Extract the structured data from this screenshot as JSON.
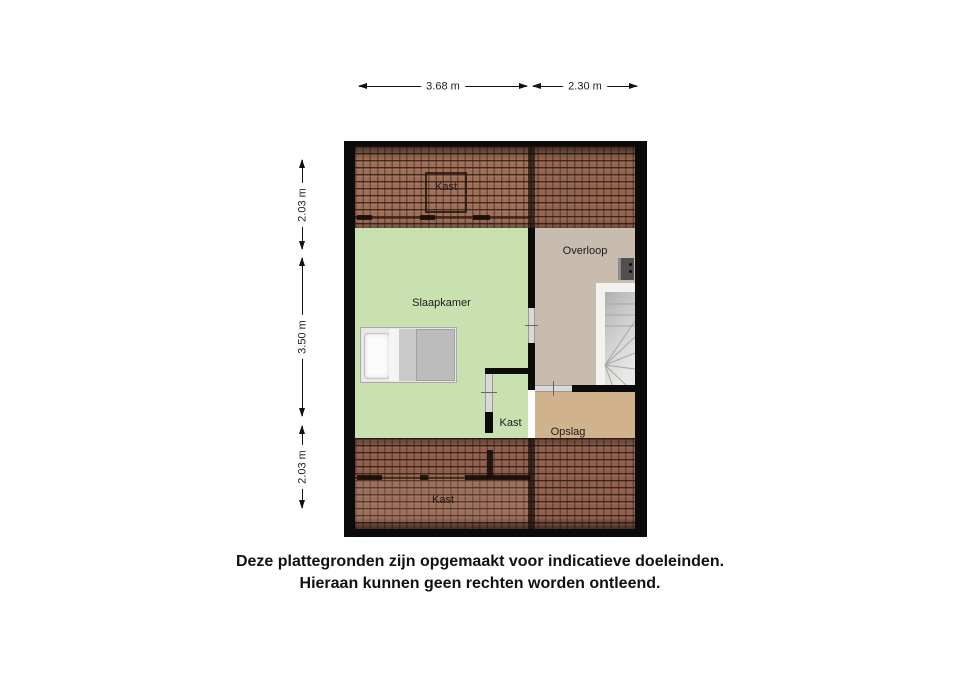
{
  "plan": {
    "rooms": [
      {
        "id": "kast-top",
        "label": "Kast"
      },
      {
        "id": "slaapkamer",
        "label": "Slaapkamer"
      },
      {
        "id": "overloop",
        "label": "Overloop"
      },
      {
        "id": "kast-middle",
        "label": "Kast"
      },
      {
        "id": "opslag",
        "label": "Opslag"
      },
      {
        "id": "kast-bottom",
        "label": "Kast"
      }
    ],
    "dimensions_top": [
      {
        "label": "3.68 m"
      },
      {
        "label": "2.30 m"
      }
    ],
    "dimensions_left": [
      {
        "label": "2.03 m"
      },
      {
        "label": "3.50 m"
      },
      {
        "label": "2.03 m"
      }
    ],
    "fixtures": [
      "bed",
      "stairs",
      "mechanical-unit"
    ]
  },
  "disclaimer": {
    "line1": "Deze plattegronden zijn opgemaakt voor indicatieve doeleinden.",
    "line2": "Hieraan kunnen geen rechten worden ontleend."
  },
  "colors": {
    "background": "#ffffff",
    "wall": "#0b0b0b",
    "bedroom_green": "#c9e0b1",
    "landing_beige": "#c7bcae",
    "storage_tan": "#d0b38c",
    "roof_top_base": "#9f6f58",
    "roof_bottom_base": "#91604e",
    "stairs_gray": "#c9c9c9"
  }
}
